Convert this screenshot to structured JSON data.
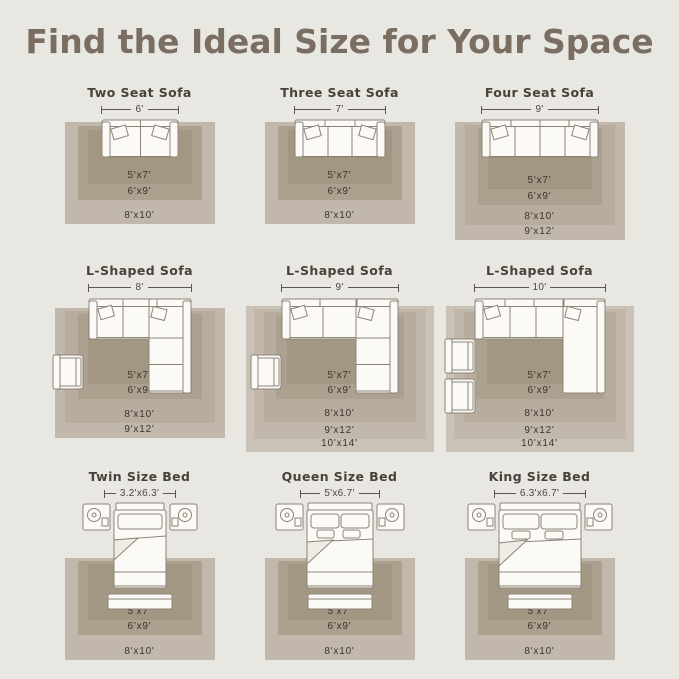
{
  "page": {
    "title": "Find the Ideal Size for Your Space"
  },
  "colors": {
    "background": "#e9e7e2",
    "title_text": "#7a6e62",
    "panel_title_text": "#49423a",
    "ruler": "#5c554c",
    "rug_label_text": "#3b352d",
    "rug_shades_inner_to_outer": [
      "#a29783",
      "#aca08f",
      "#b7ac9d",
      "#c1b8ab",
      "#cac2b6"
    ],
    "furniture_fill": "#fbfaf6",
    "furniture_stroke": "#8d8478"
  },
  "cells": [
    {
      "title": "Two Seat Sofa",
      "dimension": "6'",
      "furniture": "two-seat-sofa",
      "rugs": [
        "5'x7'",
        "6'x9'",
        "8'x10'"
      ]
    },
    {
      "title": "Three Seat Sofa",
      "dimension": "7'",
      "furniture": "three-seat-sofa",
      "rugs": [
        "5'x7'",
        "6'x9'",
        "8'x10'"
      ]
    },
    {
      "title": "Four Seat Sofa",
      "dimension": "9'",
      "furniture": "four-seat-sofa",
      "rugs": [
        "5'x7'",
        "6'x9'",
        "8'x10'",
        "9'x12'"
      ]
    },
    {
      "title": "L-Shaped Sofa",
      "dimension": "8'",
      "furniture": "l-shaped-sofa",
      "rugs": [
        "5'x7'",
        "6'x9'",
        "8'x10'",
        "9'x12'"
      ]
    },
    {
      "title": "L-Shaped Sofa",
      "dimension": "9'",
      "furniture": "l-shaped-sofa",
      "rugs": [
        "5'x7'",
        "6'x9'",
        "8'x10'",
        "9'x12'",
        "10'x14'"
      ]
    },
    {
      "title": "L-Shaped Sofa",
      "dimension": "10'",
      "furniture": "l-shaped-sofa",
      "rugs": [
        "5'x7'",
        "6'x9'",
        "8'x10'",
        "9'x12'",
        "10'x14'"
      ]
    },
    {
      "title": "Twin Size Bed",
      "dimension": "3.2'x6.3'",
      "furniture": "twin-bed",
      "rugs": [
        "5'x7'",
        "6'x9'",
        "8'x10'"
      ]
    },
    {
      "title": "Queen Size Bed",
      "dimension": "5'x6.7'",
      "furniture": "queen-bed",
      "rugs": [
        "5'x7'",
        "6'x9'",
        "8'x10'"
      ]
    },
    {
      "title": "King Size Bed",
      "dimension": "6.3'x6.7'",
      "furniture": "king-bed",
      "rugs": [
        "5'x7'",
        "6'x9'",
        "8'x10'"
      ]
    }
  ]
}
